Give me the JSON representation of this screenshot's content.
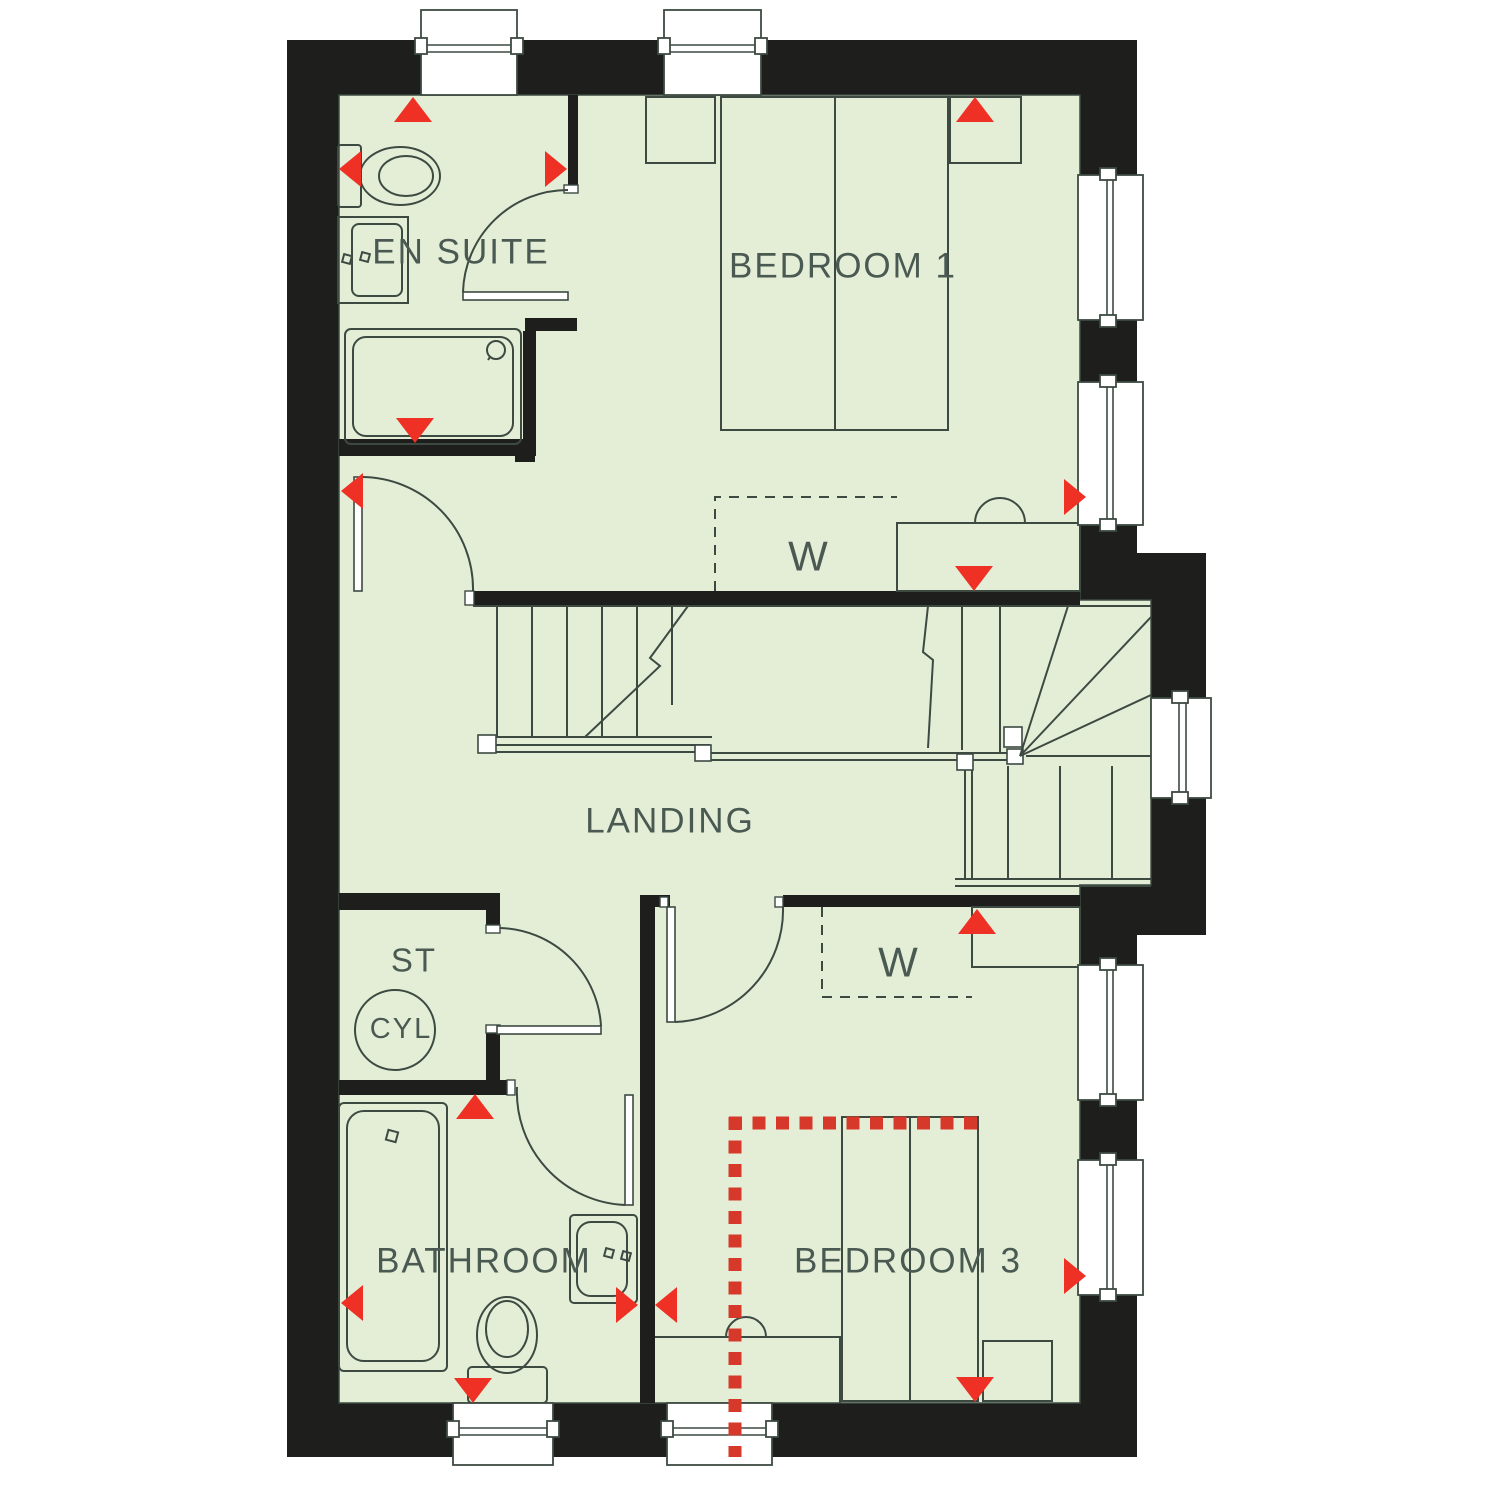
{
  "labels": {
    "en_suite": "EN SUITE",
    "bedroom_1": "BEDROOM 1",
    "landing": "LANDING",
    "st": "ST",
    "cyl": "CYL",
    "bathroom": "BATHROOM",
    "bedroom_3": "BEDROOM 3",
    "wardrobe_bedroom_1": "W",
    "wardrobe_bedroom_3": "W"
  },
  "rooms": [
    {
      "id": "en-suite",
      "label": "EN SUITE"
    },
    {
      "id": "bedroom-1",
      "label": "BEDROOM 1"
    },
    {
      "id": "landing",
      "label": "LANDING"
    },
    {
      "id": "storage",
      "label": "ST"
    },
    {
      "id": "bathroom",
      "label": "BATHROOM"
    },
    {
      "id": "bedroom-3",
      "label": "BEDROOM 3"
    }
  ],
  "fixture_icons": [
    "toilet-icon",
    "basin-icon",
    "shower-tray-icon",
    "bath-icon",
    "hot-water-cylinder-icon",
    "double-bed-icon",
    "single-bed-icon",
    "wardrobe-icon",
    "staircase-icon",
    "window-icon",
    "door-swing-icon",
    "direction-marker-icon"
  ],
  "colors": {
    "wall": "#1e1e1c",
    "floor": "#e4eed7",
    "line": "#3c4a42",
    "text": "#4a5a52",
    "marker": "#ee3124",
    "dotted": "#d6392a",
    "paper": "#ffffff"
  }
}
